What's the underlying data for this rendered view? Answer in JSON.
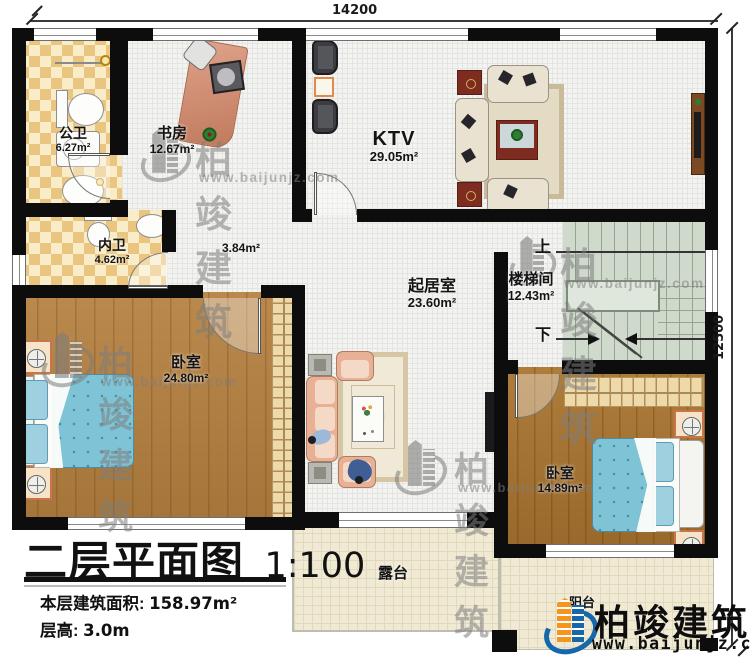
{
  "title_block": {
    "title": "二层平面图",
    "scale": "1:100",
    "area_label": "本层建筑面积:",
    "area_value": "158.97m²",
    "floor_label": "层高:",
    "floor_value": "3.0m"
  },
  "dimensions": {
    "top": "14200",
    "right": "12500"
  },
  "rooms": {
    "gongwei": {
      "name": "公卫",
      "area": "6.27m²"
    },
    "shufang": {
      "name": "书房",
      "area": "12.67m²"
    },
    "ktv": {
      "name": "KTV",
      "area": "29.05m²"
    },
    "neiwei": {
      "name": "内卫",
      "area": "4.62m²"
    },
    "corridor": {
      "area": "3.84m²"
    },
    "qijushi": {
      "name": "起居室",
      "area": "23.60m²"
    },
    "loutijian": {
      "name": "楼梯间",
      "area": "12.43m²"
    },
    "bedroom1": {
      "name": "卧室",
      "area": "24.80m²"
    },
    "bedroom2": {
      "name": "卧室",
      "area": "14.89m²"
    },
    "terrace": {
      "name": "露台"
    },
    "balcony": {
      "name": "阳台"
    }
  },
  "stairs": {
    "up": "上",
    "down": "下"
  },
  "watermark": {
    "brand": "柏竣建筑",
    "url": "www.baijunjz.com"
  },
  "logo": {
    "brand": "柏竣建筑",
    "url": "www.baijunjz.com"
  },
  "colors": {
    "wall": "#0d0d0d",
    "brand_blue": "#1767ab",
    "brand_orange": "#f7941d",
    "checker_tan": "#eac57f",
    "wood": "#b5803f",
    "stair_green": "#cfd9cc",
    "terrace_beige": "#f0ead5",
    "bed_blue": "#7fc3d6"
  }
}
